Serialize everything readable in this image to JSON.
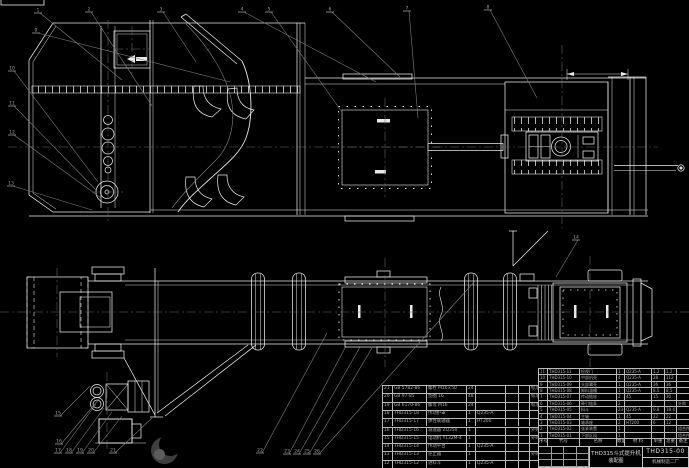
{
  "drawing": {
    "title": "THD315斗式提升机",
    "subtitle": "装配图",
    "drawing_no": "THD315-00",
    "company": "机械制造二厂"
  },
  "bom": {
    "header": [
      "序号",
      "代号",
      "名称",
      "数量",
      "材 料",
      "单重",
      "总重",
      "备注"
    ],
    "left_rows": [
      [
        "21",
        "GB 5782-86",
        "螺栓 M16×50",
        "24",
        "",
        "",
        "",
        "标准件"
      ],
      [
        "20",
        "GB 97-85",
        "垫圈 16",
        "48",
        "",
        "",
        "",
        "标准件"
      ],
      [
        "19",
        "GB 6170-86",
        "螺母 M16",
        "24",
        "",
        "",
        "",
        "标准件"
      ],
      [
        "18",
        "THD315-18",
        "传动护罩",
        "1",
        "Q235-A",
        "",
        "",
        ""
      ],
      [
        "17",
        "THD315-17",
        "弹性联轴器",
        "1",
        "HT200",
        "",
        "",
        ""
      ],
      [
        "16",
        "THD315-16",
        "减速器 ZQ350",
        "1",
        "",
        "",
        "",
        "外购"
      ],
      [
        "15",
        "THD315-15",
        "电动机 Y132M-4",
        "1",
        "",
        "",
        "",
        "外购"
      ],
      [
        "14",
        "THD315-14",
        "传动平台",
        "1",
        "Q235-A",
        "",
        "",
        ""
      ],
      [
        "13",
        "THD315-13",
        "逆止器",
        "1",
        "",
        "",
        "",
        "外购"
      ],
      [
        "12",
        "THD315-12",
        "进料斗",
        "1",
        "Q235-A",
        "",
        "",
        ""
      ]
    ],
    "right_rows": [
      [
        "11",
        "THD315-11",
        "检视门",
        "1",
        "Q235-A",
        "1.2",
        "1.2",
        ""
      ],
      [
        "10",
        "THD315-10",
        "中部机壳",
        "4",
        "Q235-A",
        "28",
        "112",
        ""
      ],
      [
        "9",
        "THD315-09",
        "头部罩壳",
        "1",
        "Q235-A",
        "36",
        "36",
        ""
      ],
      [
        "8",
        "THD315-08",
        "卸料溜槽",
        "1",
        "Q235-A",
        "8.5",
        "8.5",
        ""
      ],
      [
        "7",
        "THD315-07",
        "传动链轮",
        "2",
        "45",
        "15",
        "30",
        ""
      ],
      [
        "6",
        "THD315-06",
        "牵引链条",
        "2",
        "",
        "",
        "",
        "外购"
      ],
      [
        "5",
        "THD315-05",
        "料斗",
        "23",
        "Q235-A",
        "0.8",
        "18.4",
        ""
      ],
      [
        "4",
        "THD315-04",
        "主轴",
        "1",
        "45",
        "22",
        "22",
        ""
      ],
      [
        "3",
        "THD315-03",
        "轴承座",
        "2",
        "HT200",
        "6",
        "12",
        ""
      ],
      [
        "2",
        "THD315-02",
        "张紧装置",
        "1",
        "",
        "",
        "",
        "组合件"
      ],
      [
        "1",
        "THD315-01",
        "下部区段",
        "1",
        "",
        "",
        "",
        "组合件"
      ]
    ]
  },
  "balloons": [
    {
      "n": "1",
      "x": 37,
      "y": 10,
      "tx": 122,
      "ty": 80
    },
    {
      "n": "2",
      "x": 88,
      "y": 9,
      "tx": 152,
      "ty": 106
    },
    {
      "n": "3",
      "x": 160,
      "y": 9,
      "tx": 196,
      "ty": 62
    },
    {
      "n": "4",
      "x": 241,
      "y": 9,
      "tx": 376,
      "ty": 82
    },
    {
      "n": "5",
      "x": 268,
      "y": 9,
      "tx": 342,
      "ty": 112
    },
    {
      "n": "6",
      "x": 329,
      "y": 9,
      "tx": 400,
      "ty": 77
    },
    {
      "n": "7",
      "x": 406,
      "y": 8,
      "tx": 418,
      "ty": 118
    },
    {
      "n": "8",
      "x": 487,
      "y": 7,
      "tx": 537,
      "ty": 98
    },
    {
      "n": "9",
      "x": 35,
      "y": 30,
      "tx": 230,
      "ty": 82
    },
    {
      "n": "10",
      "x": 11,
      "y": 68,
      "tx": 98,
      "ty": 182
    },
    {
      "n": "11",
      "x": 11,
      "y": 103,
      "tx": 96,
      "ty": 190
    },
    {
      "n": "12",
      "x": 11,
      "y": 132,
      "tx": 101,
      "ty": 198
    },
    {
      "n": "13",
      "x": 10,
      "y": 183,
      "tx": 92,
      "ty": 210
    },
    {
      "n": "14",
      "x": 575,
      "y": 237,
      "tx": 556,
      "ty": 277
    },
    {
      "n": "15",
      "x": 57,
      "y": 413,
      "tx": 90,
      "ty": 386
    },
    {
      "n": "16",
      "x": 58,
      "y": 441,
      "tx": 100,
      "ty": 398
    },
    {
      "n": "17",
      "x": 57,
      "y": 450,
      "tx": 96,
      "ty": 404
    },
    {
      "n": "18",
      "x": 68,
      "y": 450,
      "tx": 104,
      "ty": 408
    },
    {
      "n": "19",
      "x": 79,
      "y": 450,
      "tx": 112,
      "ty": 412
    },
    {
      "n": "20",
      "x": 90,
      "y": 450,
      "tx": 122,
      "ty": 416
    },
    {
      "n": "21",
      "x": 112,
      "y": 450,
      "tx": 152,
      "ty": 418
    },
    {
      "n": "22",
      "x": 259,
      "y": 450,
      "tx": 327,
      "ty": 333
    },
    {
      "n": "23",
      "x": 286,
      "y": 451,
      "tx": 346,
      "ty": 346
    },
    {
      "n": "24",
      "x": 296,
      "y": 451,
      "tx": 360,
      "ty": 347
    },
    {
      "n": "25",
      "x": 306,
      "y": 451,
      "tx": 372,
      "ty": 348
    },
    {
      "n": "26",
      "x": 316,
      "y": 451,
      "tx": 475,
      "ty": 281
    }
  ],
  "colors": {
    "background": "#000000",
    "line": "#e9e9e9",
    "leader": "#7d7d7d",
    "centerline": "#6a6a6a",
    "table_text": "#aeaeae",
    "title_text": "#d8d8d8"
  }
}
